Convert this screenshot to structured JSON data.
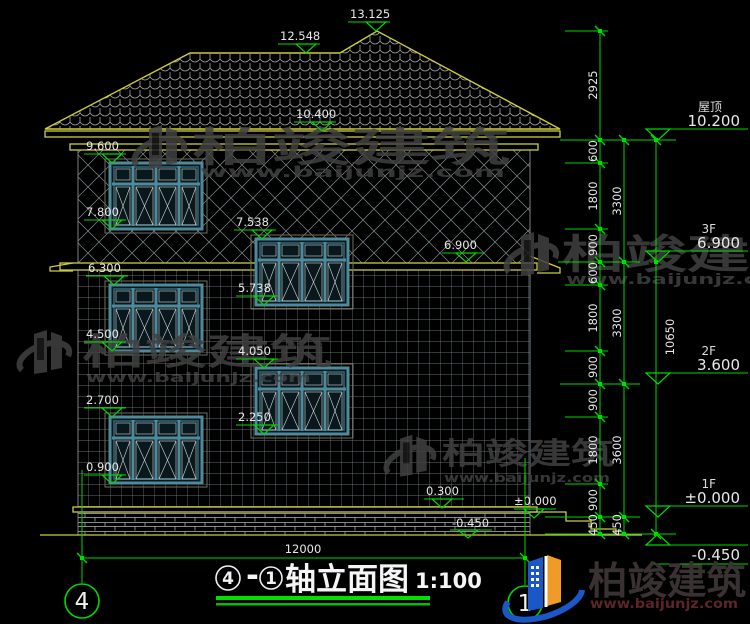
{
  "drawing": {
    "title": {
      "axis_left": "4",
      "dash": "-",
      "axis_right": "1",
      "name": "轴立面图",
      "scale": "1:100"
    },
    "bottom_dimension": "12000",
    "axis_bubbles": {
      "left": "4",
      "right": "1"
    }
  },
  "marks": {
    "peak": "13.125",
    "ridge": "12.548",
    "eave_top": "10.400",
    "l9600": "9.600",
    "l7800": "7.800",
    "l6300": "6.300",
    "l4500": "4.500",
    "l2700": "2.700",
    "l0900": "0.900",
    "c7538": "7.538",
    "c5738": "5.738",
    "c4050": "4.050",
    "c2250": "2.250",
    "r6900": "6.900",
    "b0300": "0.300",
    "bzero": "±0.000",
    "bneg": "-0.450"
  },
  "levels": [
    {
      "name": "屋顶",
      "elev": "10.200"
    },
    {
      "name": "3F",
      "elev": "6.900"
    },
    {
      "name": "2F",
      "elev": "3.600"
    },
    {
      "name": "1F",
      "elev": "±0.000"
    },
    {
      "name": "",
      "elev": "-0.450"
    }
  ],
  "dims": {
    "chain1": [
      "2925",
      "600",
      "1800",
      "900",
      "600",
      "1800",
      "900",
      "900",
      "1800",
      "900",
      "450"
    ],
    "chain2": [
      "3300",
      "3300",
      "3600",
      "450"
    ],
    "total": "10650"
  },
  "watermark": {
    "brand": "柏竣建筑",
    "url": "www.baijunjz.com"
  },
  "logo": {
    "brand": "柏竣建筑",
    "url": "www.baijunjz.com"
  },
  "colors": {
    "dim_green": "#00d800",
    "cad_yellow": "#cdcd3e",
    "logo_blue": "#1c57c8",
    "logo_orange": "#f09a28"
  }
}
